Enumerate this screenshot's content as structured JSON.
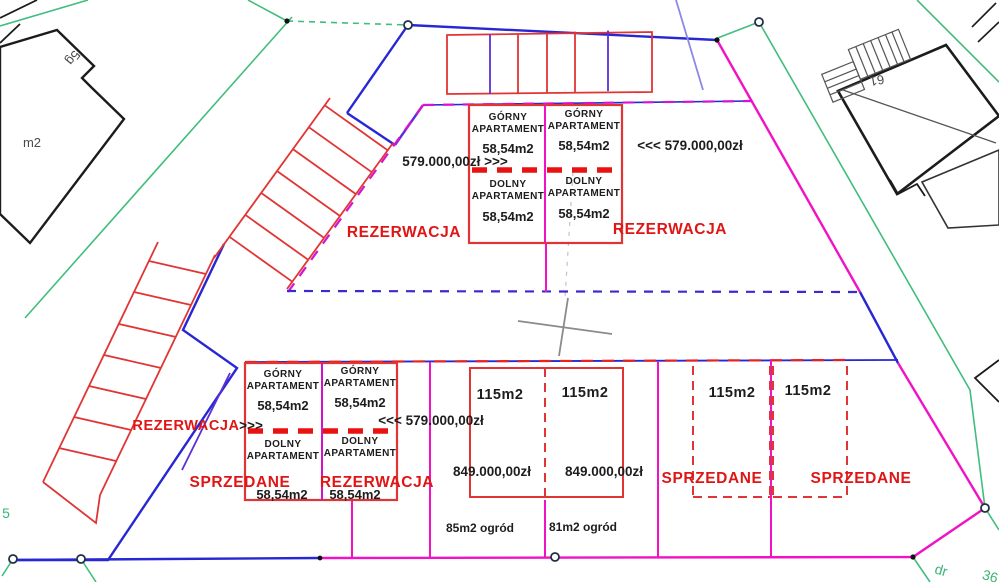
{
  "palette": {
    "status_red": "#e01515",
    "outline_red": "#e13535",
    "boundary_magenta": "#f012c4",
    "boundary_blue": "#2727d3",
    "divider_violet": "#5c2fd6",
    "parcel_green": "#41bd7e"
  },
  "upper_building": {
    "left_unit": {
      "floor_top_1": "GÓRNY",
      "floor_top_2": "APARTAMENT",
      "area_top": "58,54m2",
      "floor_bottom_1": "DOLNY",
      "floor_bottom_2": "APARTAMENT",
      "area_bottom": "58,54m2",
      "price": "579.000,00zł >>>",
      "status": "REZERWACJA"
    },
    "right_unit": {
      "floor_top_1": "GÓRNY",
      "floor_top_2": "APARTAMENT",
      "area_top": "58,54m2",
      "floor_bottom_1": "DOLNY",
      "floor_bottom_2": "APARTAMENT",
      "area_bottom": "58,54m2",
      "price": "<<< 579.000,00zł",
      "status": "REZERWACJA"
    }
  },
  "lower_building": {
    "label_left": "REZERWACJA",
    "arrows_left": ">>>",
    "price_right": "<<< 579.000,00zł",
    "left_unit": {
      "floor_top_1": "GÓRNY",
      "floor_top_2": "APARTAMENT",
      "area_top": "58,54m2",
      "floor_bottom_1": "DOLNY",
      "floor_bottom_2": "APARTAMENT",
      "area_bottom": "58,54m2",
      "status": "SPRZEDANE"
    },
    "right_unit": {
      "floor_top_1": "GÓRNY",
      "floor_top_2": "APARTAMENT",
      "area_top": "58,54m2",
      "floor_bottom_1": "DOLNY",
      "floor_bottom_2": "APARTAMENT",
      "area_bottom": "58,54m2",
      "status": "REZERWACJA"
    }
  },
  "row_houses": {
    "plot1": {
      "area": "115m2",
      "price": "849.000,00zł",
      "garden": "85m2 ogród"
    },
    "plot2": {
      "area": "115m2",
      "price": "849.000,00zł",
      "garden": "81m2 ogród"
    },
    "plot3": {
      "area": "115m2",
      "status": "SPRZEDANE"
    },
    "plot4": {
      "area": "115m2",
      "status": "SPRZEDANE"
    }
  },
  "surroundings": {
    "left_building_label": "5g",
    "left_building_area": "m2",
    "right_building_label": "61",
    "parcel_number_left": "5",
    "road_label": "dr",
    "parcel_number_bottom": "36"
  }
}
